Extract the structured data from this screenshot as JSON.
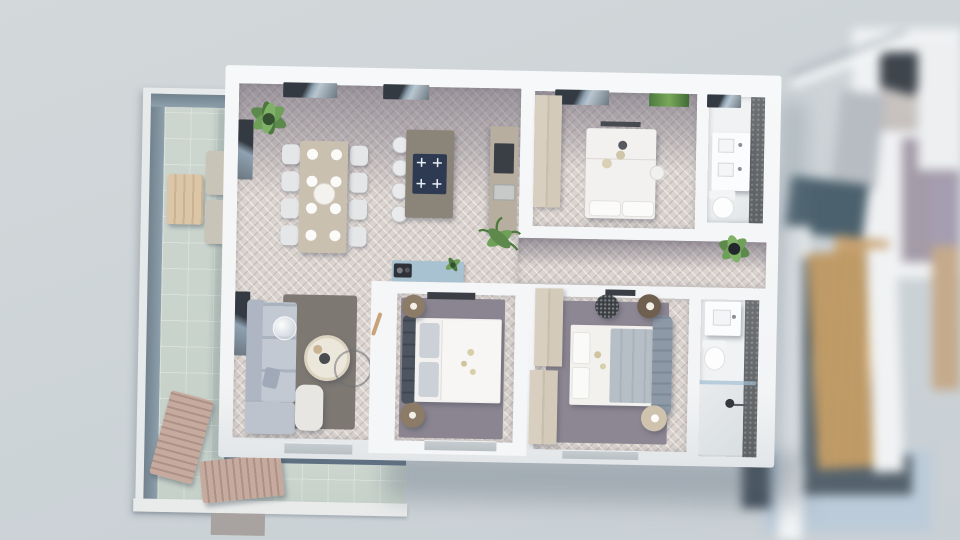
{
  "scene": {
    "title": "3D top-down floor plan render of an apartment",
    "view": "bird's-eye architectural visualization, neighbor unit out of focus at right",
    "palette": {
      "background": "#ccd3d7",
      "wall": "#f5f6f7",
      "floor_light_herringbone": "#dad3ce",
      "floor_dark_herringbone": "#918b96",
      "rug_gray": "#8b8591",
      "rug_brown": "#7d7872",
      "sofa_gray": "#b6bec9",
      "wood_beige": "#d8cfc0",
      "dining_table": "#c9c0b0",
      "island": "#8b8478",
      "cooktop_navy": "#2d3a51",
      "counter": "#b7ae9f",
      "console_blue": "#a9c2d1",
      "terrace_floor_green": "#ccd6cf",
      "terrace_glass": "#7b8c98",
      "lounger_tan": "#c7aa9e",
      "bathroom_tile_dark": "#6d7073",
      "plant_green": "#5d8a4c",
      "neighbor_teal": "#4b616d",
      "stair_wood": "#cda86f",
      "platform_blue": "#bccbd9",
      "shadow": "#5e7082"
    },
    "apartment": {
      "rooms": [
        {
          "id": "living-dining-kitchen",
          "furniture": [
            "dining-table",
            "dining-chairs x8",
            "dinner-plates x8",
            "center-platter",
            "kitchen-island",
            "cooktop-4-burners",
            "bar-stools x4",
            "kitchen-counter",
            "wall-oven",
            "corner-sofa",
            "armchair",
            "coffee-table",
            "floor-lamp",
            "wire-chair",
            "area-rug",
            "blue-sideboard",
            "record-player",
            "corner-plants",
            "palm-plant",
            "sideboard-plant"
          ]
        },
        {
          "id": "bedroom-1",
          "furniture": [
            "double-bed",
            "pillows x2",
            "wardrobe",
            "pendant-lamp",
            "stool",
            "wall-art-green"
          ]
        },
        {
          "id": "bathroom-1",
          "furniture": [
            "double-vanity",
            "toilet",
            "dark-tile-wall"
          ]
        },
        {
          "id": "hallway",
          "furniture": [
            "potted-plant"
          ]
        },
        {
          "id": "bedroom-2",
          "furniture": [
            "double-bed",
            "upholstered-headboard",
            "pillows x2",
            "nightstands x2",
            "tv-console",
            "area-rug",
            "terrace-door"
          ]
        },
        {
          "id": "bedroom-3",
          "furniture": [
            "double-bed",
            "tufted-headboard",
            "blanket",
            "wardrobes x2",
            "nightstands x2",
            "patterned-pouf",
            "tv-console",
            "area-rug"
          ]
        },
        {
          "id": "bathroom-2",
          "furniture": [
            "vanity",
            "toilet",
            "walk-in-shower",
            "glass-partition",
            "dark-tile-wall"
          ]
        }
      ],
      "windows": [
        "living-window x2",
        "living-side-window x2",
        "bedroom1-window",
        "bathroom1-window",
        "sliding-doors x2"
      ]
    },
    "terrace": {
      "railing": "glass balustrade",
      "furniture": [
        "outdoor-dining-table",
        "outdoor-benches x2",
        "sun-loungers x2"
      ],
      "floor": "pale green tiles",
      "extras": [
        "white-curb",
        "walkway-stub"
      ]
    },
    "neighbor_building": {
      "state": "blurred / out of focus",
      "features": [
        "upper-floor-rooms",
        "teal-deck",
        "white-railing",
        "wooden-staircase",
        "glass-stair-screen",
        "light-blue-terrace-platform",
        "beige-wall"
      ]
    }
  }
}
